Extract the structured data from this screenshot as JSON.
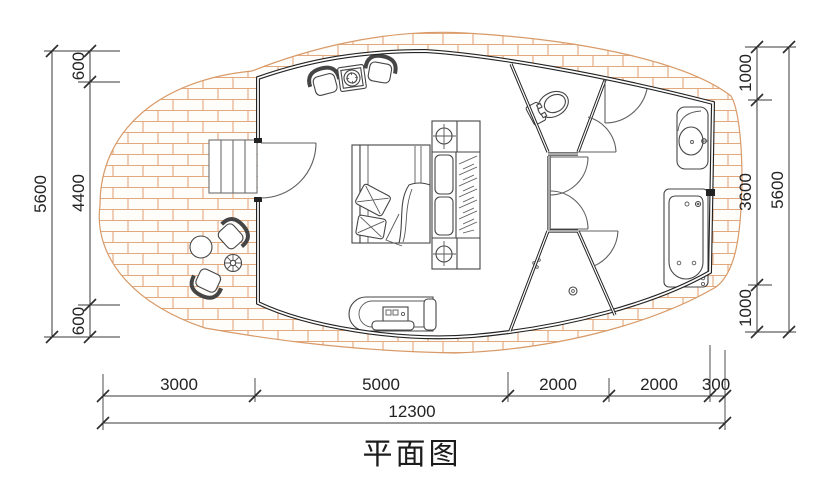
{
  "title": "平面图",
  "dims": {
    "left": {
      "total": "5600",
      "segments": [
        "600",
        "4400",
        "600"
      ]
    },
    "right": {
      "total": "5600",
      "segments": [
        "1000",
        "3600",
        "1000"
      ]
    },
    "bottom": {
      "total": "12300",
      "segments": [
        "3000",
        "5000",
        "2000",
        "2000",
        "300"
      ]
    }
  },
  "colors": {
    "ink": "#232323",
    "furniture_line": "#454545",
    "deck_hatch": "#e3a97e",
    "deck_edge": "#d89a68",
    "paper": "#ffffff"
  },
  "fixtures": [
    "wood-deck",
    "entry-steps",
    "entry-door",
    "double-bed",
    "wardrobe",
    "armchair",
    "coffee-table",
    "daybed",
    "toilet",
    "shower",
    "washbasin",
    "bathtub",
    "outdoor-table",
    "outdoor-chair",
    "potted-plant"
  ]
}
